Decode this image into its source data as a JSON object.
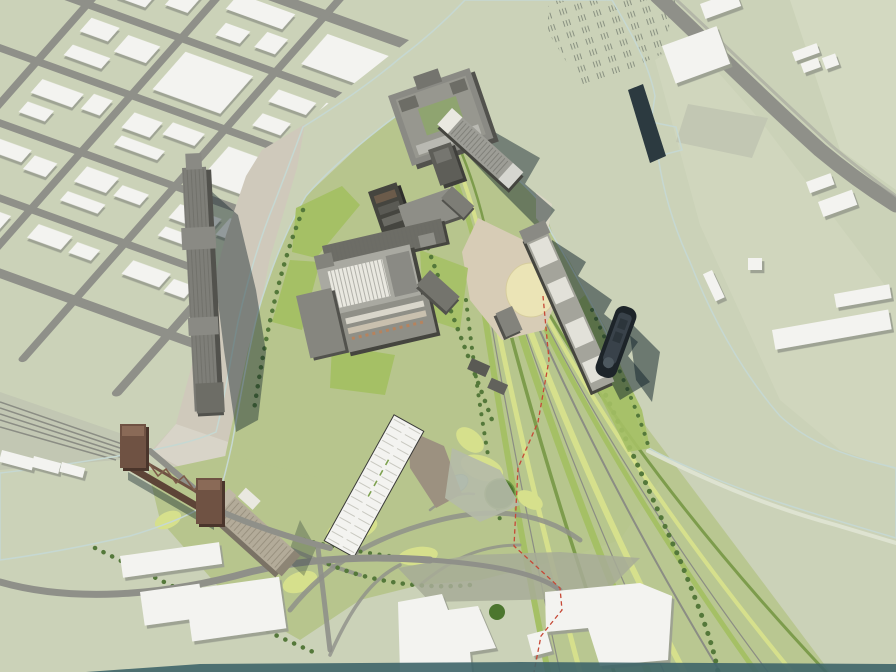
{
  "scene": {
    "description": "Aerial axonometric architectural rendering of a riverfront master plan: an industrial peninsula of converted grain silos and mills surrounded by a dark teal river, a context street grid to the northwest, a rust-colored vertical-lift truss bridge, a fan of rail lines and green landscape strips sweeping south through parkland, and an east bank with warehouses.",
    "style": "3d-massing-site-plan-render",
    "view": "oblique-aerial"
  },
  "colors": {
    "land": "#cbd2b8",
    "land_light": "#d6dcc4",
    "land_gray": "#c2c7b3",
    "park_base": "#b7c58d",
    "park_bright": "#d6e08c",
    "park_green": "#a5c065",
    "park_dark": "#7d9c4c",
    "tree": "#54783a",
    "tree_dark": "#4c762e",
    "water": "#2b4d58",
    "water_deep": "#1d3a44",
    "shore": "#c6d8d2",
    "shore_sand": "#e0e4d4",
    "road": "#8f9089",
    "road_light": "#a8a9a0",
    "rail": "#8b8d84",
    "white_top": "#f3f3f0",
    "white_shade": "#d6d6d0",
    "gray_top": "#8a8a84",
    "gray_mid": "#6d6d66",
    "gray_side": "#52524d",
    "gray_dark": "#45453f",
    "silo_white": "#e9e8e0",
    "elevator_top": "#7e7e78",
    "tan_top": "#b3ab99",
    "tan_side": "#7a7265",
    "quay": "#cfc9bb",
    "quay_light": "#d8d4c8",
    "plaza": "#d7ccb6",
    "lawn_cream": "#ebe4b6",
    "pond": "#8ec2d3",
    "pond_edge": "#6fa3b5",
    "bridge": "#6f5243",
    "bridge_dark": "#4a352b",
    "bridge_light": "#8a6a57",
    "rust": "#5d4437",
    "boundary": "#c64836",
    "ship": "#1d2429",
    "ship_deck": "#39424a",
    "hatch": "#8a9282",
    "shadow_water": "#0d2027",
    "shadow_building": "#9ba092",
    "shadow_ind": "#55564f",
    "wedge": "#a7ac97",
    "lot_tan": "#9c9180",
    "concrete": "#b5baa8",
    "bottom_strip": "#3f6569"
  },
  "features": {
    "context_city": "Street grid with low white buildings (northwest)",
    "river": "Dark teal river encircling the peninsula",
    "peninsula": "Redevelopment site of converted mill and silo buildings",
    "north_mill_complex": "Large mill block with courtyard at the north tip",
    "waterfront_silo_row": "Long silo building along the east waterfront",
    "west_bank_elevator": "Long grain elevator on the west quay",
    "lift_bridge": "Rust-colored vertical-lift truss bridge",
    "bridge_side_elevator": "Tan cylindrical silo elevator at the bridge landing",
    "ship": "Dark-hulled ship moored off the east shore",
    "circular_lawn": "Pale circular lawn beside the east plaza",
    "rail_corridor": "Fan of rail lines and green strips sweeping south",
    "south_park": "Landscaped park with paths, pond and tree groves",
    "pond": "Small blue pond",
    "tree_grove": "Large dark-green tree circle",
    "parking_lot": "Long striped surface parking lot",
    "south_warehouses": "Flat white warehouse buildings along the south edge",
    "boundary_line": "Red dashed site boundary",
    "east_bank": "East bank with diagonal road, warehouses and rail-yard hatching"
  }
}
